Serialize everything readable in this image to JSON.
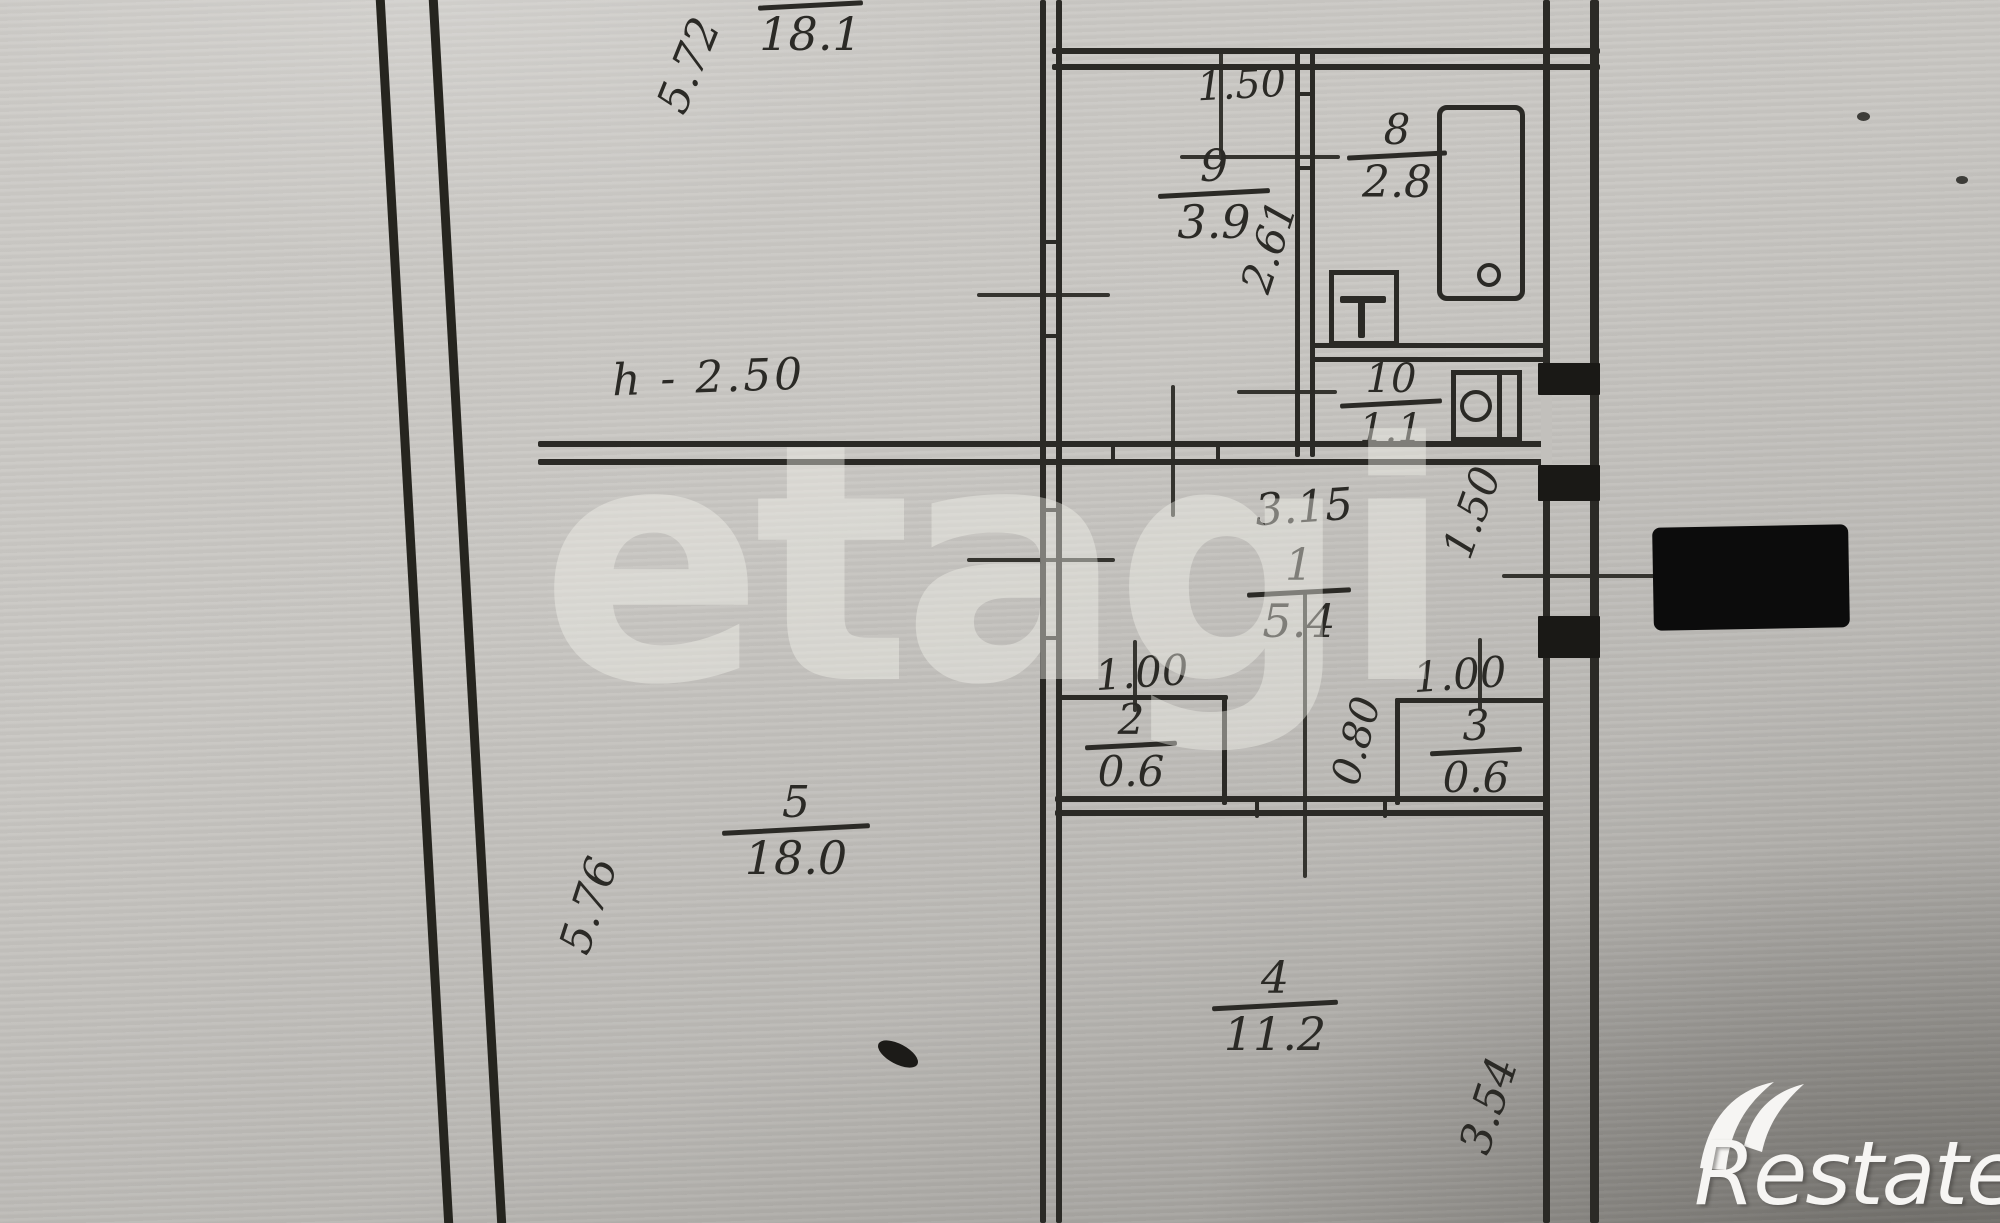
{
  "watermark": {
    "text": "etagi"
  },
  "brand": {
    "logo_text": "Restate"
  },
  "colors": {
    "ink": "#2b2a26",
    "paper": "#c8c6c2",
    "redaction": "#0c0c0c",
    "logo": "#f6f5f3"
  },
  "plan": {
    "height_label": "h - 2.50",
    "rooms": {
      "r6": {
        "number": "6",
        "area": "18.1"
      },
      "r9": {
        "number": "9",
        "area": "3.9"
      },
      "r8": {
        "number": "8",
        "area": "2.8"
      },
      "r10": {
        "number": "10",
        "area": "1.1"
      },
      "r1": {
        "number": "1",
        "area": "5.4"
      },
      "r2": {
        "number": "2",
        "area": "0.6"
      },
      "r3": {
        "number": "3",
        "area": "0.6"
      },
      "r5": {
        "number": "5",
        "area": "18.0"
      },
      "r4": {
        "number": "4",
        "area": "11.2"
      }
    },
    "dimensions": {
      "left_top_wall": "5.72",
      "left_bottom_wall": "5.76",
      "kitchen_width": "1.50",
      "kitchen_depth": "2.61",
      "hall_width": "3.15",
      "balcony_door": "1.50",
      "closet2_width": "1.00",
      "closet3_width": "1.00",
      "passage_width": "0.80",
      "room4_depth": "3.54"
    }
  }
}
